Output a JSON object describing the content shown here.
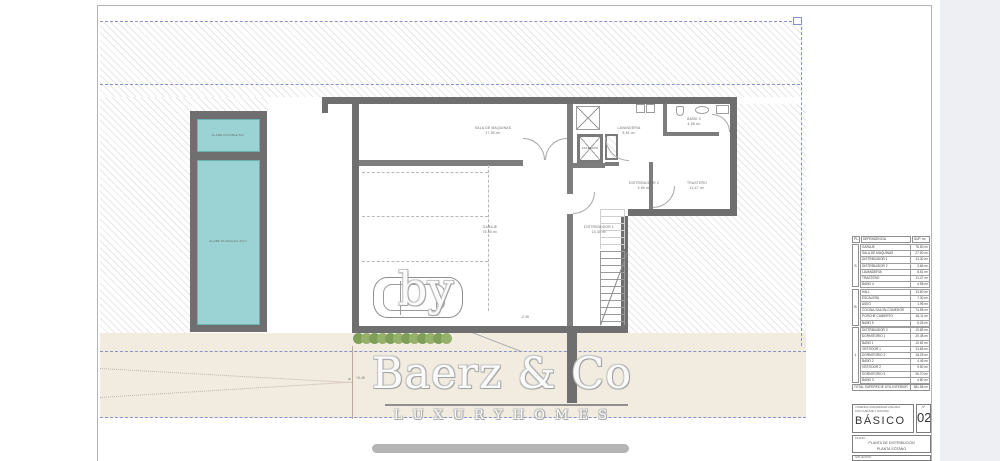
{
  "colors": {
    "wall": "#6f6f6f",
    "pool_teal": "#9bd2d4",
    "setback_dash_blue": "#8a90c8",
    "driveway_beige": "#f1ecdf",
    "vegetation_green": "#7e9f55",
    "watermark_gray": "#b4b4b4"
  },
  "plan": {
    "pool": {
      "tank1_label": "ALJIBE POTABLE 6m³",
      "tank2_label": "ALJIBE PLUVIALES 44m³"
    },
    "rooms": {
      "sala": {
        "name": "SALA DE MAQUINAS",
        "area": "27.50 m²"
      },
      "garaje": {
        "name": "GARAJE",
        "area": "76.50 m²"
      },
      "dist1": {
        "name": "DISTRIBUIDOR 1",
        "area": "13.30 m²"
      },
      "dist2": {
        "name": "DISTRIBUIDOR 2",
        "area": "3.66 m²"
      },
      "lavanderia": {
        "name": "LAVANDERIA",
        "area": "8.51 m²"
      },
      "trastero": {
        "name": "TRASTERO",
        "area": "11.47 m²"
      },
      "bano4": {
        "name": "BAÑO 4",
        "area": "4.58 m²"
      },
      "ascensor": {
        "name": "ASCENSOR"
      }
    },
    "annotations": {
      "level_a": "-0.45",
      "level_b": "+0.45"
    }
  },
  "watermark": {
    "by": "by",
    "brand": "Baerz & Co",
    "tagline": "L U X U R Y   H O M E S"
  },
  "table": {
    "headers": {
      "c1": "PL.",
      "c2": "DEPENDENCIA",
      "c3": "SUP. m²"
    },
    "groups": [
      {
        "label": "S",
        "rows": [
          {
            "n": "GARAJE",
            "a": "76.50 m²"
          },
          {
            "n": "SALA DE MAQUINAS",
            "a": "27.50 m²"
          },
          {
            "n": "DISTRIBUIDOR 1",
            "a": "13.30 m²"
          },
          {
            "n": "DISTRIBUIDOR 2",
            "a": "3.66 m²"
          },
          {
            "n": "LAVANDERIA",
            "a": "8.51 m²"
          },
          {
            "n": "TRASTERO",
            "a": "11.47 m²"
          },
          {
            "n": "BAÑO 4",
            "a": "4.58 m²"
          }
        ]
      },
      {
        "label": "B",
        "rows": [
          {
            "n": "HALL",
            "a": "13.60 m²"
          },
          {
            "n": "ESCALERA",
            "a": "7.30 m²"
          },
          {
            "n": "ASEO",
            "a": "1.95 m²"
          },
          {
            "n": "COCINA-SALON-COMEDOR",
            "a": "74.55 m²"
          },
          {
            "n": "PORCHE CUBIERTO",
            "a": "18.11 m²"
          },
          {
            "n": "BAÑO 5",
            "a": "6.25 m²"
          }
        ]
      },
      {
        "label": "1",
        "rows": [
          {
            "n": "DISTRIBUIDOR 3",
            "a": "13.89 m²"
          },
          {
            "n": "DORMITORIO 1",
            "a": "20.38 m²"
          },
          {
            "n": "BAÑO 1",
            "a": "10.82 m²"
          },
          {
            "n": "VESTIDOR 1",
            "a": "13.65 m²"
          },
          {
            "n": "DORMITORIO 2",
            "a": "18.25 m²"
          },
          {
            "n": "BAÑO 2",
            "a": "4.45 m²"
          },
          {
            "n": "VESTIDOR 2",
            "a": "9.50 m²"
          },
          {
            "n": "DORMITORIO 3",
            "a": "26.70 m²"
          },
          {
            "n": "BAÑO 3",
            "a": "4.80 m²"
          }
        ]
      }
    ],
    "total_label": "TOTAL SUPERFICIE ÚTIL INTERIOR",
    "total_value": "381.58 m²"
  },
  "title_block": {
    "project_line1": "VIVIENDA UNIFAMILIAR AISLADA",
    "project_line2": "CON GARAJE Y PISCINA",
    "phase": "BÁSICO",
    "number_label": "Nº",
    "number": "02",
    "plan_label": "PLANO:",
    "plan_line1": "PLANTA DE DISTRIBUCIÓN",
    "plan_line2": "PLANTA SÓTANO",
    "situacion_label": "SITUACIÓN:"
  }
}
